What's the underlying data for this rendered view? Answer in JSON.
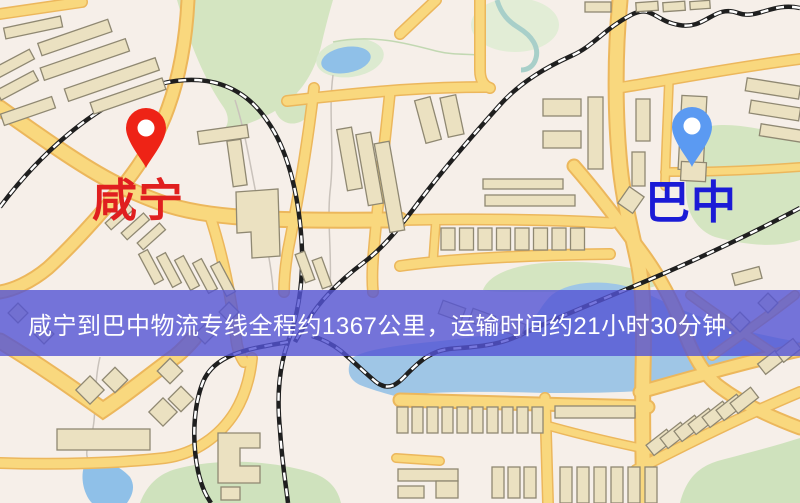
{
  "banner": {
    "text": "咸宁到巴中物流专线全程约1367公里，运输时间约21小时30分钟.",
    "background_color": "#5454d4",
    "text_color": "#ffffff"
  },
  "map": {
    "markers": [
      {
        "id": "origin",
        "label": "咸宁",
        "pin_color": "#ee2316",
        "label_color": "#e01f1f"
      },
      {
        "id": "destination",
        "label": "巴中",
        "pin_color": "#5b9af2",
        "label_color": "#1b1bd6"
      }
    ],
    "colors": {
      "background": "#f6efe9",
      "road_fill": "#f9d87e",
      "road_casing": "#ecb75c",
      "building_fill": "#ebe1c1",
      "building_outline": "#8f8872",
      "green_area": "#d4e5c1",
      "water": "#9fc6e6",
      "railway": "#1f1f1f"
    }
  }
}
